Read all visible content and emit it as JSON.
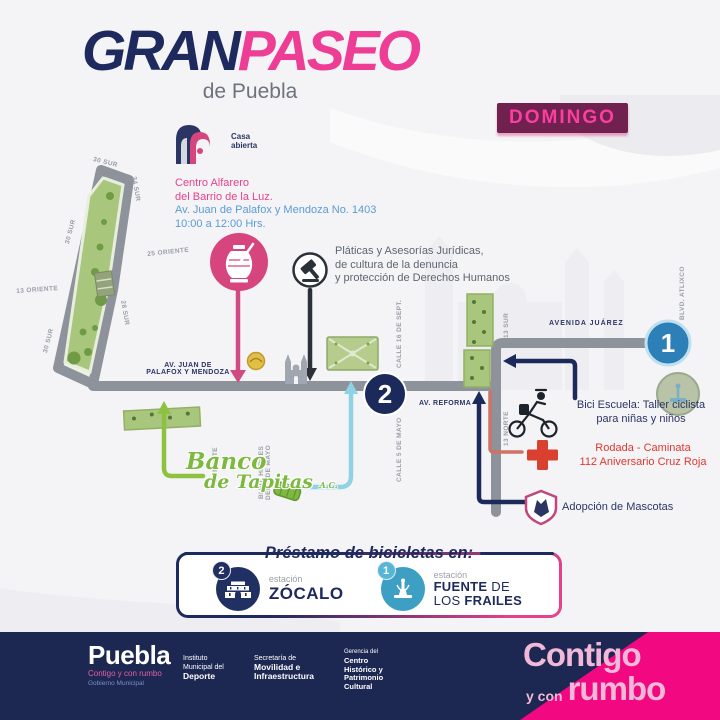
{
  "title": {
    "part1": "GRAN",
    "part2": "PASEO",
    "subtitle": "de Puebla"
  },
  "badge": {
    "day": "DOMINGO"
  },
  "casa_abierta": {
    "line1": "Casa",
    "line2": "abierta"
  },
  "venue": {
    "name1": "Centro Alfarero",
    "name2": "del Barrio de la Luz.",
    "address": "Av. Juan de Palafox y Mendoza No. 1403",
    "hours": "10:00 a 12:00 Hrs."
  },
  "streets": {
    "sur30_top": "30 SUR",
    "sur34": "34 SUR",
    "sur30_left": "30 SUR",
    "oriente13": "13 ORIENTE",
    "sur30_sw": "30 SUR",
    "sur28": "28 SUR",
    "oriente25": "25 ORIENTE",
    "palafox1": "AV. JUAN DE",
    "palafox2": "PALAFOX Y MENDOZA",
    "calle16": "CALLE 16 DE SEPT.",
    "calle5": "CALLE 5 DE MAYO",
    "norte30": "30 NORTE",
    "heroes1": "BLVD. HÉROES",
    "heroes2": "DEL 5 DE MAYO",
    "reforma": "AV. REFORMA",
    "juarez": "AVENIDA JUÁREZ",
    "sur13": "13 SUR",
    "norte13": "13 NORTE",
    "atlixco": "BLVD. ATLIXCO"
  },
  "notes": {
    "juridicas1": "Pláticas y Asesorías Jurídicas,",
    "juridicas2": "de cultura de la denuncia",
    "juridicas3": "y protección de Derechos Humanos",
    "bici1": "Bici Escuela: Taller ciclista",
    "bici2": "para niñas y niños",
    "cruz1": "Rodada - Caminata",
    "cruz2": "112 Aniversario Cruz Roja",
    "mascotas": "Adopción de Mascotas"
  },
  "banco": {
    "l1": "Banco",
    "l2": "de Tapitas",
    "l3": "A.C."
  },
  "markers": {
    "one": "1",
    "two": "2"
  },
  "prestamo": {
    "title": "Préstamo de bicicletas en:",
    "station2_badge": "2",
    "station2_small": "estación",
    "station2_name": "ZÓCALO",
    "station1_badge": "1",
    "station1_small": "estación",
    "station1_l1a": "FUENTE",
    "station1_l1b": " DE",
    "station1_l2a": "LOS ",
    "station1_l2b": "FRAILES"
  },
  "footer": {
    "city": "Puebla",
    "slogan": "Contigo y con rumbo",
    "gov": "Gobierno Municipal",
    "org1_1": "Instituto",
    "org1_2": "Municipal del",
    "org1_3": "Deporte",
    "org2_1": "Secretaría de",
    "org2_2": "Movilidad e",
    "org2_3": "Infraestructura",
    "org3_1": "Gerencia del",
    "org3_2": "Centro",
    "org3_3": "Histórico y",
    "org3_4": "Patrimonio",
    "org3_5": "Cultural",
    "big1": "Contigo",
    "big2a": "y con",
    "big2b": "rumbo"
  },
  "colors": {
    "navy": "#1e2a5e",
    "pink": "#ed3d94",
    "badge_bg": "#71214f",
    "badge_text": "#fb3fa0",
    "road": "#8d929b",
    "park_green": "#a9c77c",
    "lime": "#8cc23f",
    "cyan": "#8ed2e4",
    "red": "#d9402f",
    "blue_text": "#5a9bd5",
    "pink_text": "#e8418c",
    "footer_navy": "#1c2752",
    "footer_pink": "#f20880"
  }
}
